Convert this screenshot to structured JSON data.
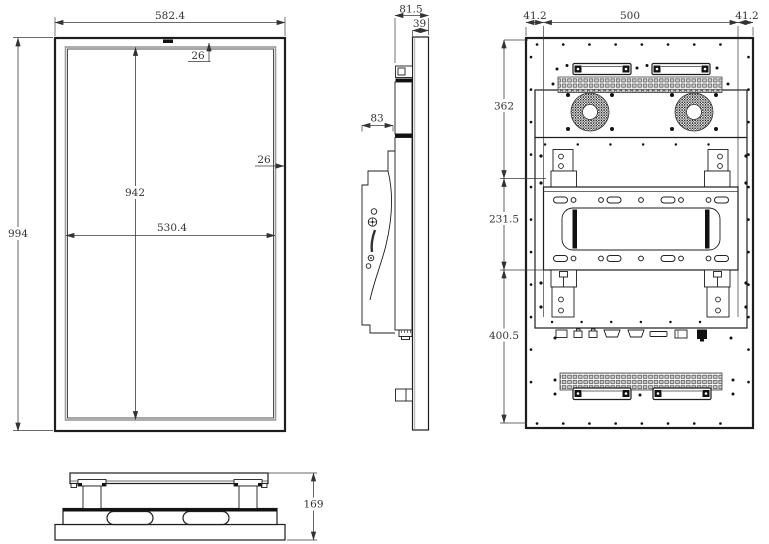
{
  "drawing": {
    "front_view": {
      "overall_width": "582.4",
      "overall_height": "994",
      "screen_width": "530.4",
      "screen_height": "942",
      "bezel_top": "26",
      "bezel_side": "26"
    },
    "side_view": {
      "overall_depth": "81.5",
      "panel_thickness": "39",
      "bracket_depth": "83"
    },
    "back_view": {
      "margin_left": "41.2",
      "mount_width": "500",
      "margin_right": "41.2",
      "upper_section": "362",
      "middle_section": "231.5",
      "lower_section": "400.5"
    },
    "bottom_view": {
      "overall_height": "169"
    },
    "colors": {
      "line": "#1d1d1d",
      "dimension_text": "#333333",
      "background": "#ffffff"
    }
  }
}
